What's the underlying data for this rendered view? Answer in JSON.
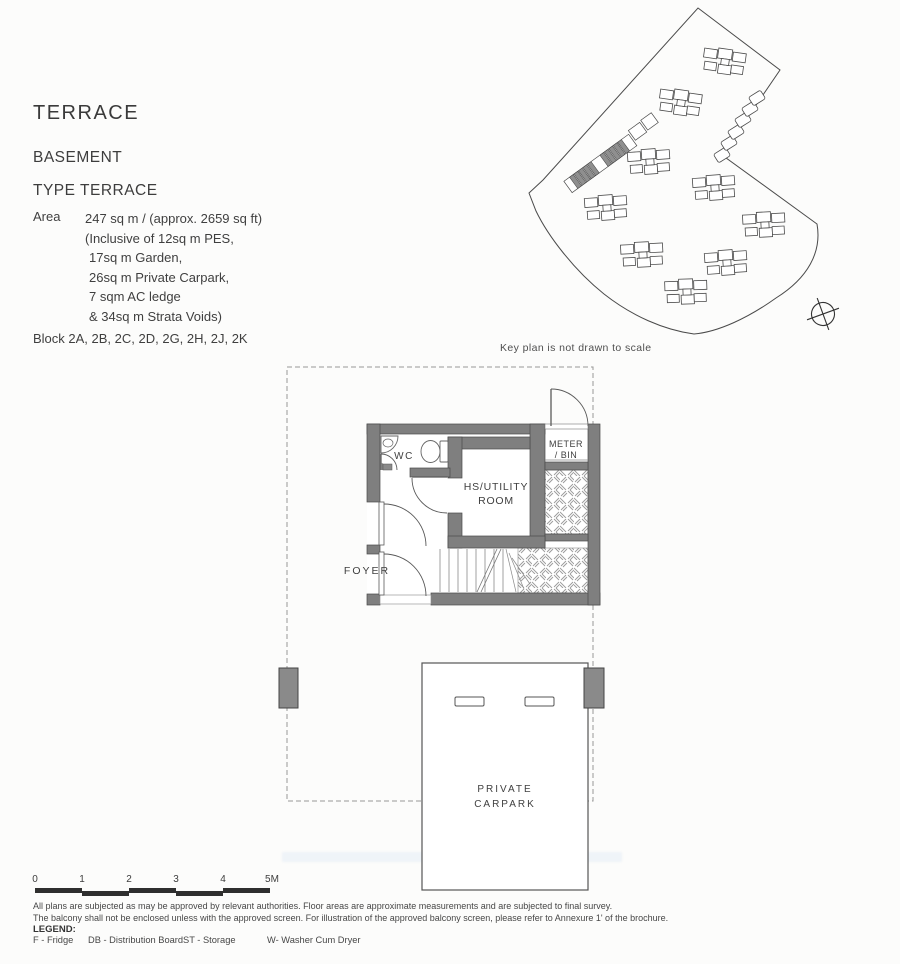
{
  "header": {
    "title": "TERRACE",
    "level": "BASEMENT",
    "type": "TYPE TERRACE",
    "area_label": "Area",
    "area_value": "247 sq m / (approx. 2659 sq ft)",
    "area_details": [
      "(Inclusive of 12sq m PES,",
      "17sq m Garden,",
      "26sq m Private Carpark,",
      "7 sqm AC ledge",
      "& 34sq m Strata Voids)"
    ],
    "blocks": "Block 2A, 2B, 2C, 2D, 2G, 2H, 2J, 2K"
  },
  "key_plan": {
    "caption": "Key plan is not drawn to scale"
  },
  "floor_plan": {
    "labels": {
      "wc": "WC",
      "utility_line1": "HS/UTILITY",
      "utility_line2": "ROOM",
      "meter_line1": "METER",
      "meter_line2": "/ BIN",
      "foyer": "FOYER",
      "carpark_line1": "PRIVATE",
      "carpark_line2": "CARPARK"
    }
  },
  "scale_bar": {
    "ticks": [
      "0",
      "1",
      "2",
      "3",
      "4",
      "5M"
    ]
  },
  "notes": [
    "All plans are subjected as may be approved by relevant authorities. Floor areas are approximate measurements and are subjected to final survey.",
    "The balcony shall not be enclosed unless with the approved screen. For illustration of the approved balcony screen, please refer to Annexure 1' of the brochure."
  ],
  "legend": {
    "label": "LEGEND:",
    "items": [
      "F - Fridge",
      "DB - Distribution Board",
      "ST - Storage",
      "W- Washer Cum Dryer"
    ]
  },
  "colors": {
    "wall_gray": "#7f7f7f",
    "pillar_gray": "#8a8a8a",
    "line_dark": "#4a4a4a",
    "hatch_line": "#9a9a9a",
    "text": "#3e3e3e"
  }
}
